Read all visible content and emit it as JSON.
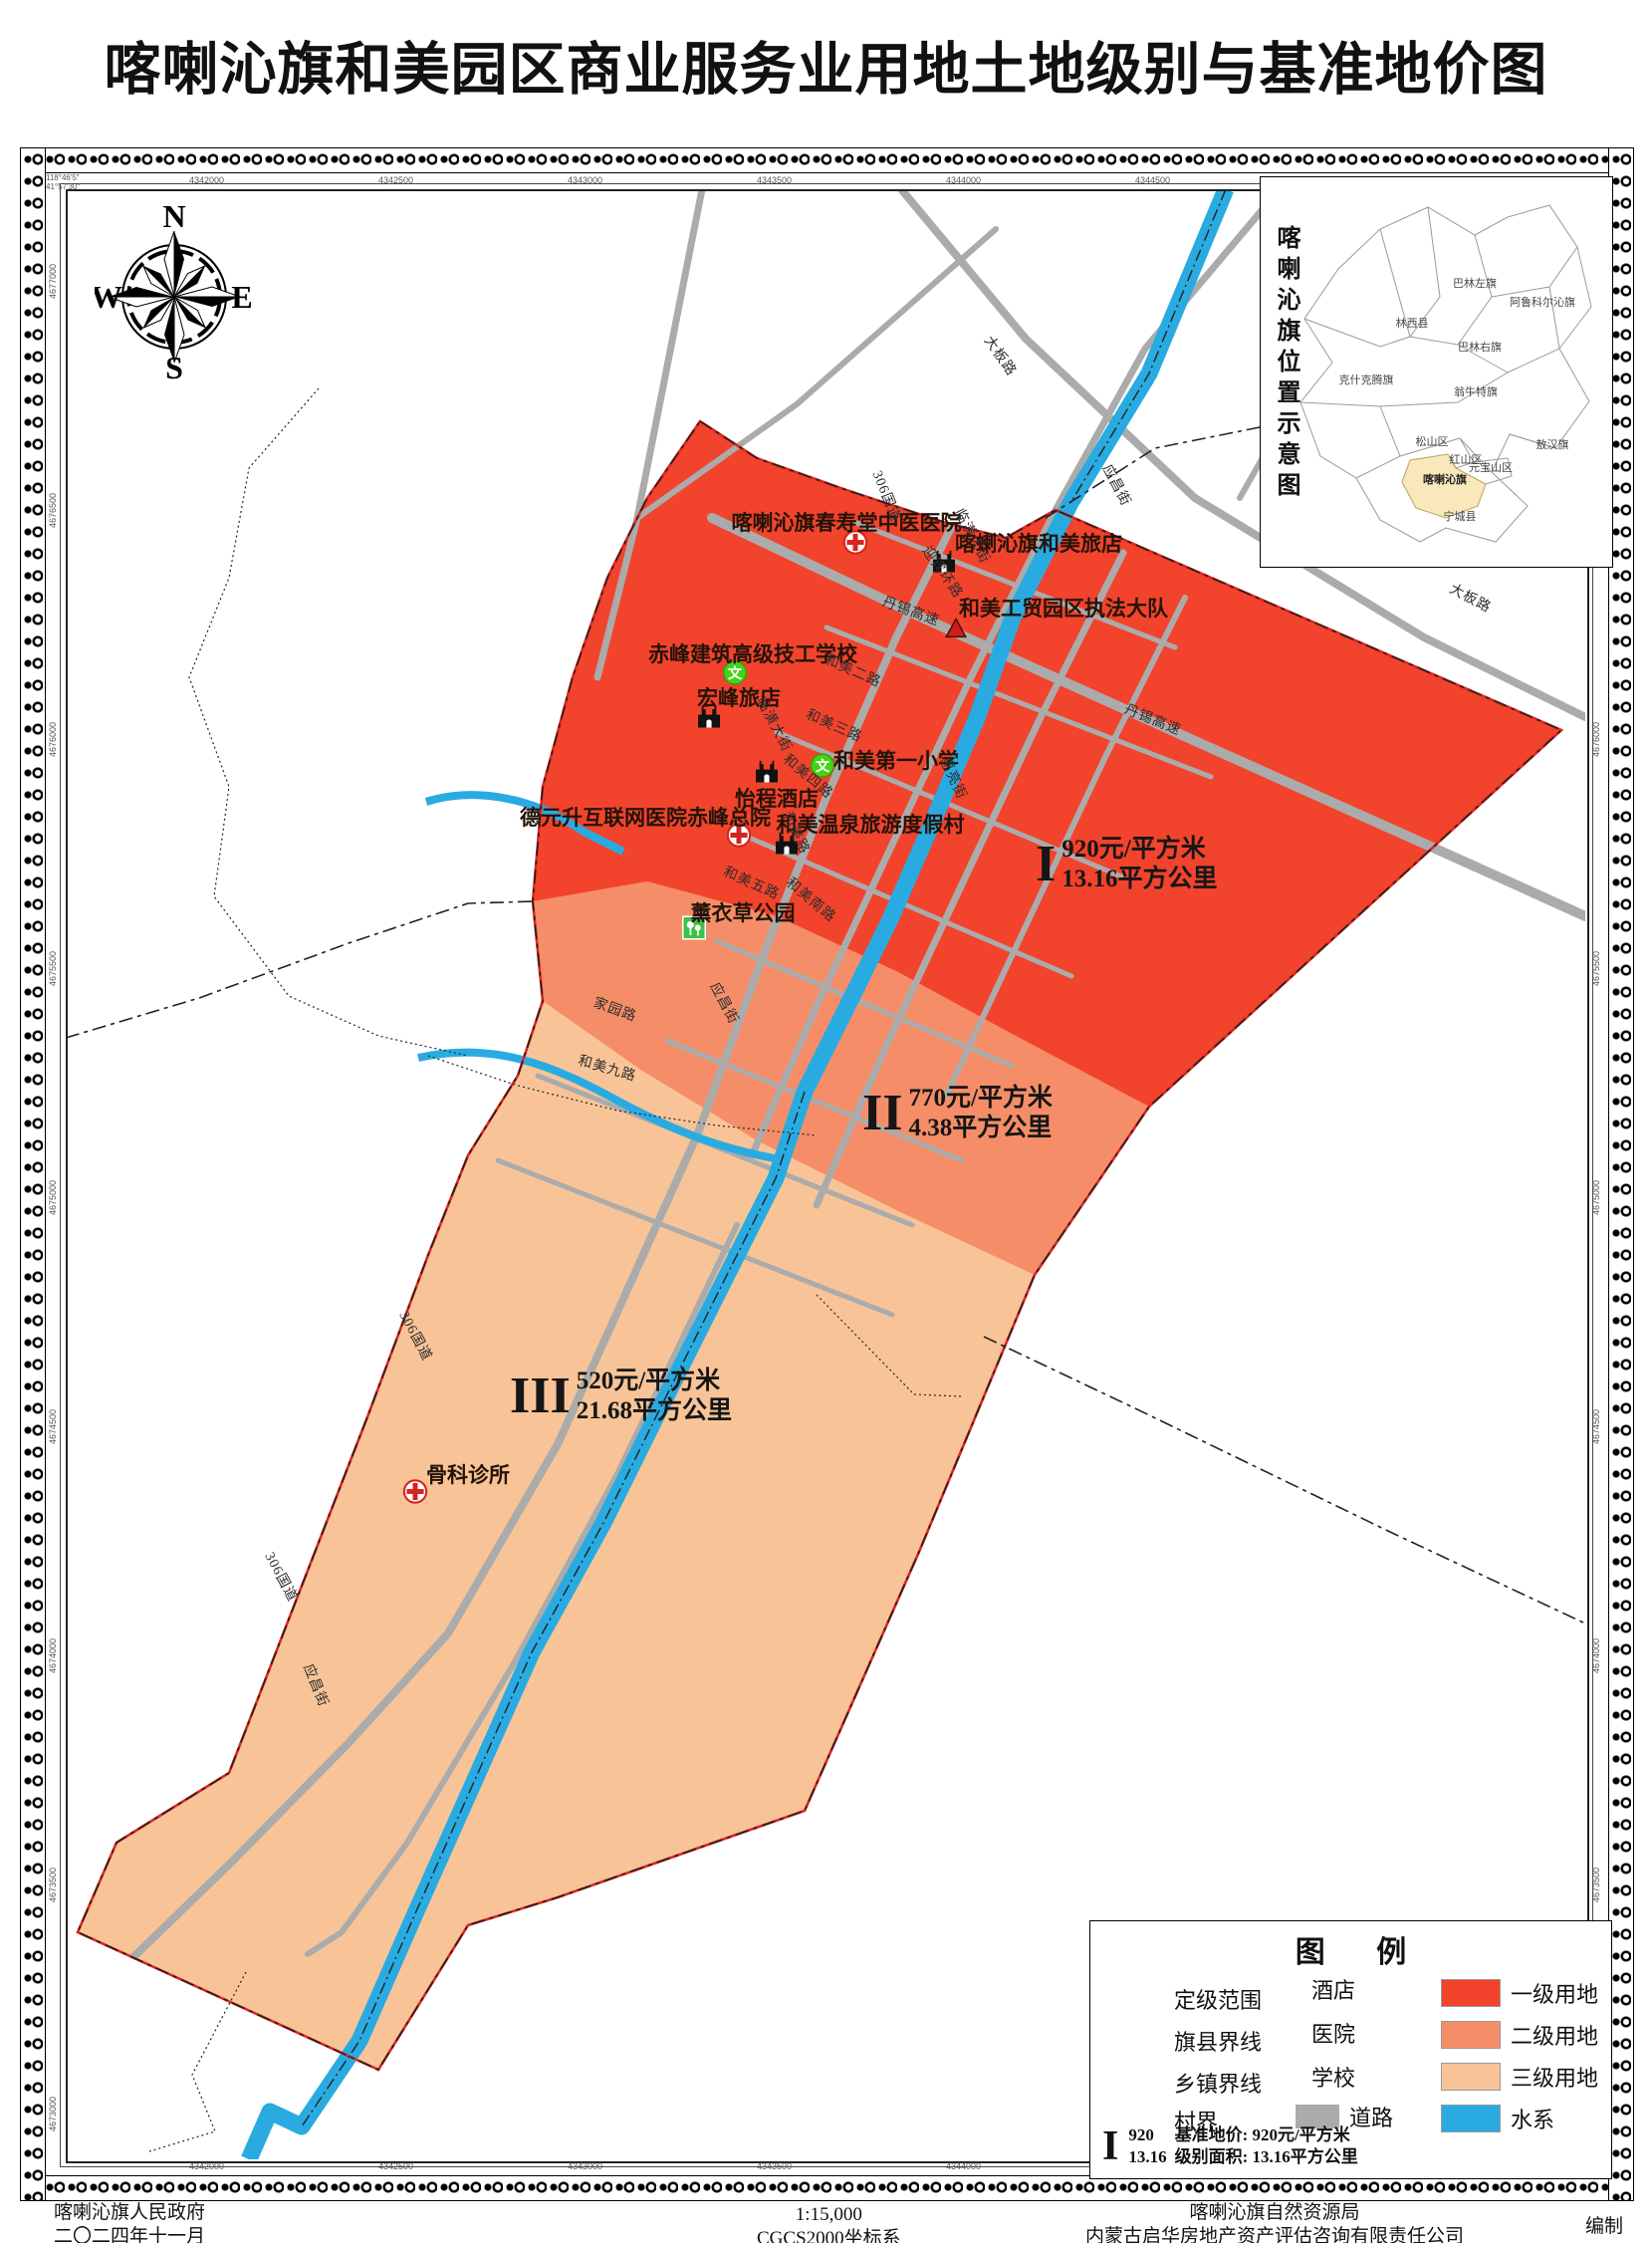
{
  "title": "喀喇沁旗和美园区商业服务业用地土地级别与基准地价图",
  "compass": {
    "north": "N",
    "south": "S",
    "east": "E",
    "west": "W"
  },
  "inset": {
    "title": "喀喇沁旗位置示意图",
    "highlight": "喀喇沁旗",
    "highlight_color": "#f9e8bb",
    "regions": [
      "巴林左旗",
      "阿鲁科尔沁旗",
      "林西县",
      "巴林右旗",
      "克什克腾旗",
      "翁牛特旗",
      "松山区",
      "红山区",
      "元宝山区",
      "敖汉旗",
      "喀喇沁旗",
      "宁城县"
    ]
  },
  "zones": [
    {
      "numeral": "I",
      "price": "920元/平方米",
      "area": "13.16平方公里",
      "color": "#f2432c",
      "name": "一级用地"
    },
    {
      "numeral": "II",
      "price": "770元/平方米",
      "area": "4.38平方公里",
      "color": "#f58e68",
      "name": "二级用地"
    },
    {
      "numeral": "III",
      "price": "520元/平方米",
      "area": "21.68平方公里",
      "color": "#f8c497",
      "name": "三级用地"
    }
  ],
  "map": {
    "pois": [
      {
        "label": "喀喇沁旗春寿堂中医医院",
        "type": "hospital"
      },
      {
        "label": "喀蝲沁旗和美旅店",
        "type": "hotel"
      },
      {
        "label": "和美工贸园区执法大队",
        "type": "enforcement"
      },
      {
        "label": "赤峰建筑高级技工学校",
        "type": "school"
      },
      {
        "label": "宏峰旅店",
        "type": "hotel"
      },
      {
        "label": "和美第一小学",
        "type": "school"
      },
      {
        "label": "怡程酒店",
        "type": "hotel"
      },
      {
        "label": "德元升互联网医院赤峰总院",
        "type": "hospital"
      },
      {
        "label": "和美温泉旅游度假村",
        "type": "hotel"
      },
      {
        "label": "薰衣草公园",
        "type": "park"
      },
      {
        "label": "骨科诊所",
        "type": "hospital"
      }
    ],
    "road_labels": [
      "大板路",
      "306国道",
      "临潢大街",
      "应昌街",
      "大板路",
      "迎宾环路",
      "丹锡高速",
      "丹锡高速",
      "临潢大街",
      "和美二路",
      "和美三路",
      "和美四路",
      "和美路",
      "和美五路",
      "和美南路",
      "惠亮街",
      "应昌街",
      "家园路",
      "和美九路",
      "306国道",
      "306国道",
      "应昌街"
    ],
    "water_color": "#29abe2",
    "road_color": "#ababab",
    "boundary_color": "#e0261f"
  },
  "legend": {
    "title": "图  例",
    "lines": [
      {
        "label": "定级范围",
        "style": "solid-red"
      },
      {
        "label": "旗县界线",
        "style": "dash"
      },
      {
        "label": "乡镇界线",
        "style": "dash-dot"
      },
      {
        "label": "村界",
        "style": "dotted"
      }
    ],
    "symbols": [
      {
        "label": "酒店",
        "type": "hotel"
      },
      {
        "label": "医院",
        "type": "hospital"
      },
      {
        "label": "学校",
        "type": "school"
      },
      {
        "label": "道路",
        "type": "road"
      }
    ],
    "areas": [
      {
        "label": "一级用地",
        "color": "#f2432c"
      },
      {
        "label": "二级用地",
        "color": "#f58e68"
      },
      {
        "label": "三级用地",
        "color": "#f8c497"
      },
      {
        "label": "水系",
        "color": "#29abe2"
      }
    ],
    "note": {
      "numeral": "I",
      "top": "920",
      "bottom": "13.16",
      "line1": "基准地价: 920元/平方米",
      "line2": "级别面积: 13.16平方公里"
    }
  },
  "frame": {
    "corner_lon": "118°46′5″",
    "corner_lat": "41°57′30″",
    "top_ticks": [
      "4342000",
      "4342500",
      "4343000",
      "4343500",
      "4344000",
      "4344500",
      "4345000",
      "4345500"
    ],
    "bottom_ticks": [
      "4342000",
      "4342500",
      "4343000",
      "4343500",
      "4344000",
      "4344500",
      "4345000",
      "4345500"
    ],
    "left_ticks": [
      "4677000",
      "4676500",
      "4676000",
      "4675500",
      "4675000",
      "4674500",
      "4674000",
      "4673500",
      "4673000"
    ],
    "right_ticks": [
      "4677000",
      "4676500",
      "4676000",
      "4675500",
      "4675000",
      "4674500",
      "4674000",
      "4673500",
      "4673000"
    ]
  },
  "footer": {
    "left1": "喀喇沁旗人民政府",
    "left2": "二〇二四年十一月",
    "center1": "1:15,000",
    "center2": "CGCS2000坐标系",
    "right1": "喀喇沁旗自然资源局",
    "right2": "内蒙古启华房地产资产评估咨询有限责任公司",
    "right3": "编制"
  }
}
